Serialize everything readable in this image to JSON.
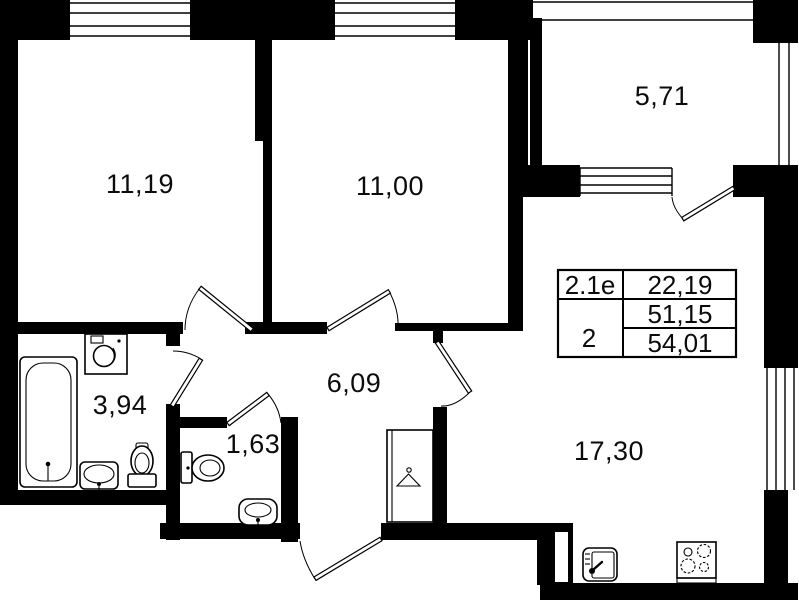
{
  "rooms": [
    {
      "id": "bedroom-1",
      "area": "11,19"
    },
    {
      "id": "bedroom-2",
      "area": "11,00"
    },
    {
      "id": "balcony",
      "area": "5,71"
    },
    {
      "id": "hallway",
      "area": "6,09"
    },
    {
      "id": "bathroom",
      "area": "3,94"
    },
    {
      "id": "wc",
      "area": "1,63"
    },
    {
      "id": "kitchen-living",
      "area": "17,30"
    }
  ],
  "info_table": {
    "code": "2.1e",
    "rooms": "2",
    "row1": "22,19",
    "row2": "51,15",
    "row3": "54,01"
  },
  "fixtures": [
    "bathtub",
    "washing-machine",
    "toilet",
    "sink",
    "wardrobe-hanger",
    "kitchen-sink",
    "stove"
  ],
  "colors": {
    "wall": "#000000",
    "background": "#ffffff",
    "line": "#0b0b0b"
  }
}
